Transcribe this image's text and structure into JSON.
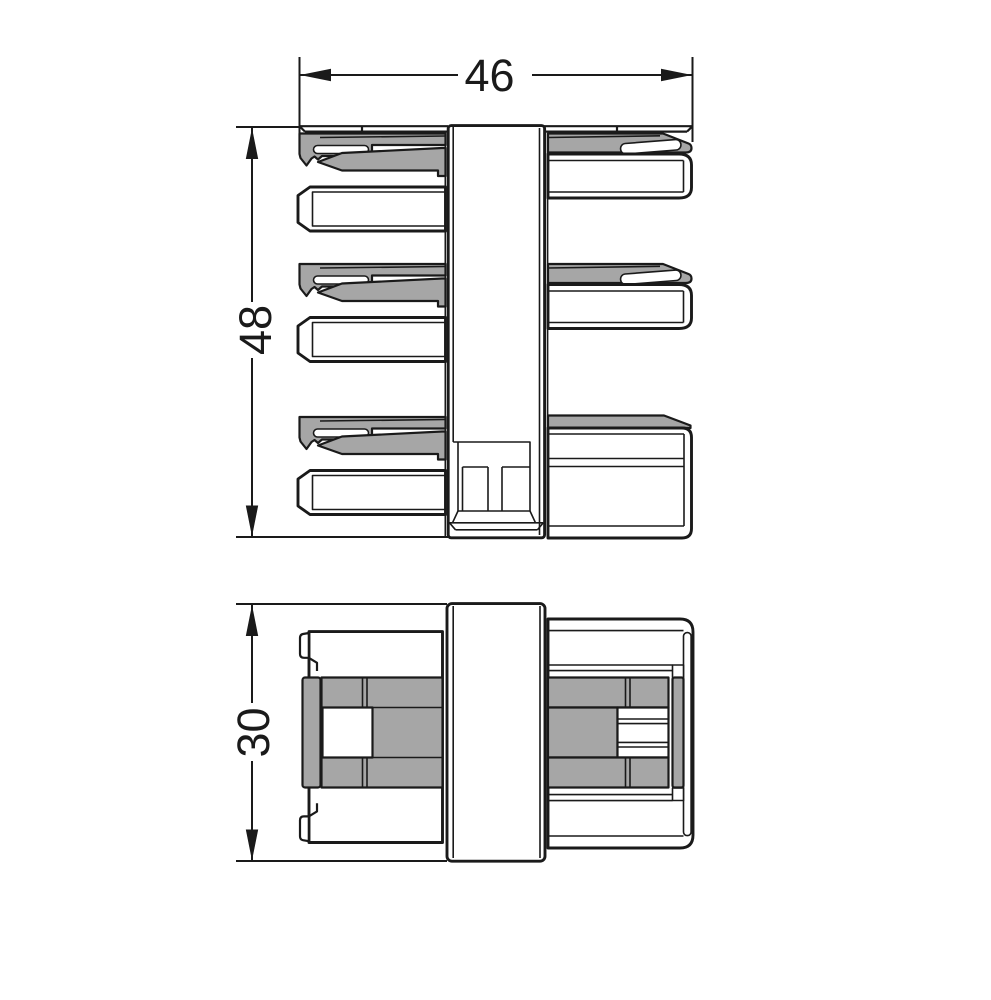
{
  "drawing": {
    "colors": {
      "line": "#1a1a1a",
      "grey_fill": "#a6a6a6",
      "background": "#ffffff"
    },
    "dimensions": {
      "overall_width_mm": "46",
      "overall_height_mm": "48",
      "housing_height_mm": "30"
    }
  }
}
